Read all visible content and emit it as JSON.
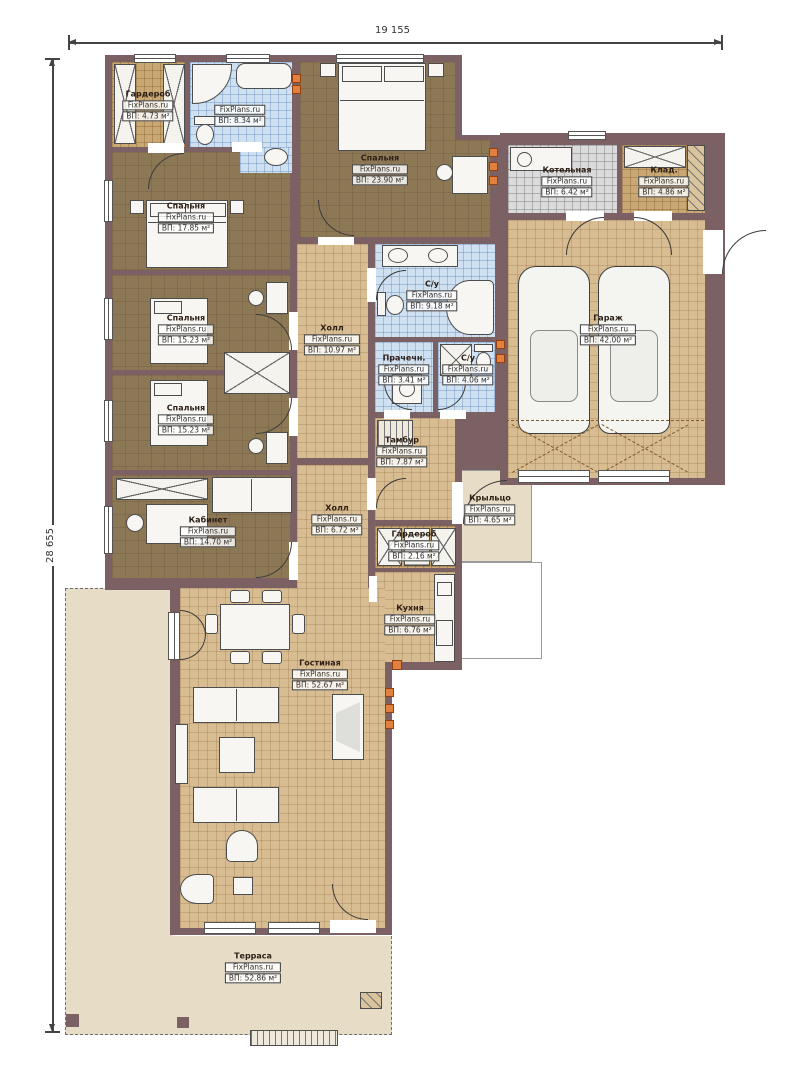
{
  "watermark": "FixPlans.ru",
  "dimensions": {
    "top": "19 155",
    "left": "28 655"
  },
  "colors": {
    "wall": "#7c6164",
    "floor_tile_tan": "#d9bd92",
    "floor_wood_brown": "#8d7856",
    "floor_bath_blue": "#cfe0f1",
    "floor_boiler_gray": "#dbdbdb",
    "floor_storage_tan": "#c9a873",
    "terrace_beige": "#e7ddc7",
    "radiator_orange": "#e2813f"
  },
  "rooms": [
    {
      "name": "Гардероб",
      "area": "ВП: 4.73 м²"
    },
    {
      "name": "",
      "area": "ВП: 8.34 м²"
    },
    {
      "name": "Спальня",
      "area": "ВП: 17.85 м²"
    },
    {
      "name": "Спальня",
      "area": "ВП: 23.90 м²"
    },
    {
      "name": "Котельная",
      "area": "ВП: 6.42 м²"
    },
    {
      "name": "Клад.",
      "area": "ВП: 4.86 м²"
    },
    {
      "name": "Гараж",
      "area": "ВП: 42.00 м²"
    },
    {
      "name": "С/у",
      "area": "ВП: 9.18 м²"
    },
    {
      "name": "Холл",
      "area": "ВП: 10.97 м²"
    },
    {
      "name": "Прачечн.",
      "area": "ВП: 3.41 м²"
    },
    {
      "name": "С/у",
      "area": "ВП: 4.06 м²"
    },
    {
      "name": "Спальня",
      "area": "ВП: 15.23 м²"
    },
    {
      "name": "Спальня",
      "area": "ВП: 15.23 м²"
    },
    {
      "name": "Кабинет",
      "area": "ВП: 14.70 м²"
    },
    {
      "name": "Холл",
      "area": "ВП: 6.72 м²"
    },
    {
      "name": "Тамбур",
      "area": "ВП: 7.87 м²"
    },
    {
      "name": "Крыльцо",
      "area": "ВП: 4.65 м²"
    },
    {
      "name": "Гардероб",
      "area": "ВП: 2.16 м²"
    },
    {
      "name": "Кухня",
      "area": "ВП: 6.76 м²"
    },
    {
      "name": "Гостиная",
      "area": "ВП: 52.67 м²"
    },
    {
      "name": "Терраса",
      "area": "ВП: 52.86 м²"
    }
  ]
}
